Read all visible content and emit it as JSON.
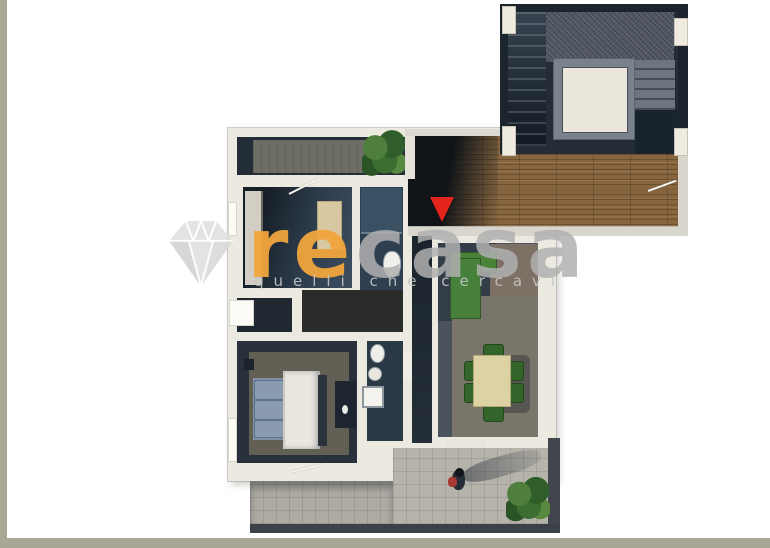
{
  "watermark": {
    "icon": "diamond-icon",
    "brand_prefix": "re",
    "brand_suffix": "casa",
    "tagline": "quelli che cercavi"
  },
  "palette": {
    "frame_olive": "#A8A695",
    "wall_white": "#ECE9E1",
    "floor_dark_navy": "#2A3540",
    "wood_floor": "#87663F",
    "terrace_tile_gray": "#B6B3AB",
    "sofa_green": "#47803A",
    "chair_green": "#33652A",
    "table_beige": "#DCD2A3",
    "bed_linen_white": "#E9E7E0",
    "pillow_blue": "#7F91A6",
    "elevator_frame_gray": "#79828D",
    "entrance_marker_red": "#E3241B",
    "brand_orange": "#F1A53D",
    "brand_gray": "#B0B0B0"
  },
  "plan_icons": {
    "entrance_marker": "red-triangle-down-icon",
    "plants": "potted-palm-icon",
    "person": "person-figure-icon"
  }
}
